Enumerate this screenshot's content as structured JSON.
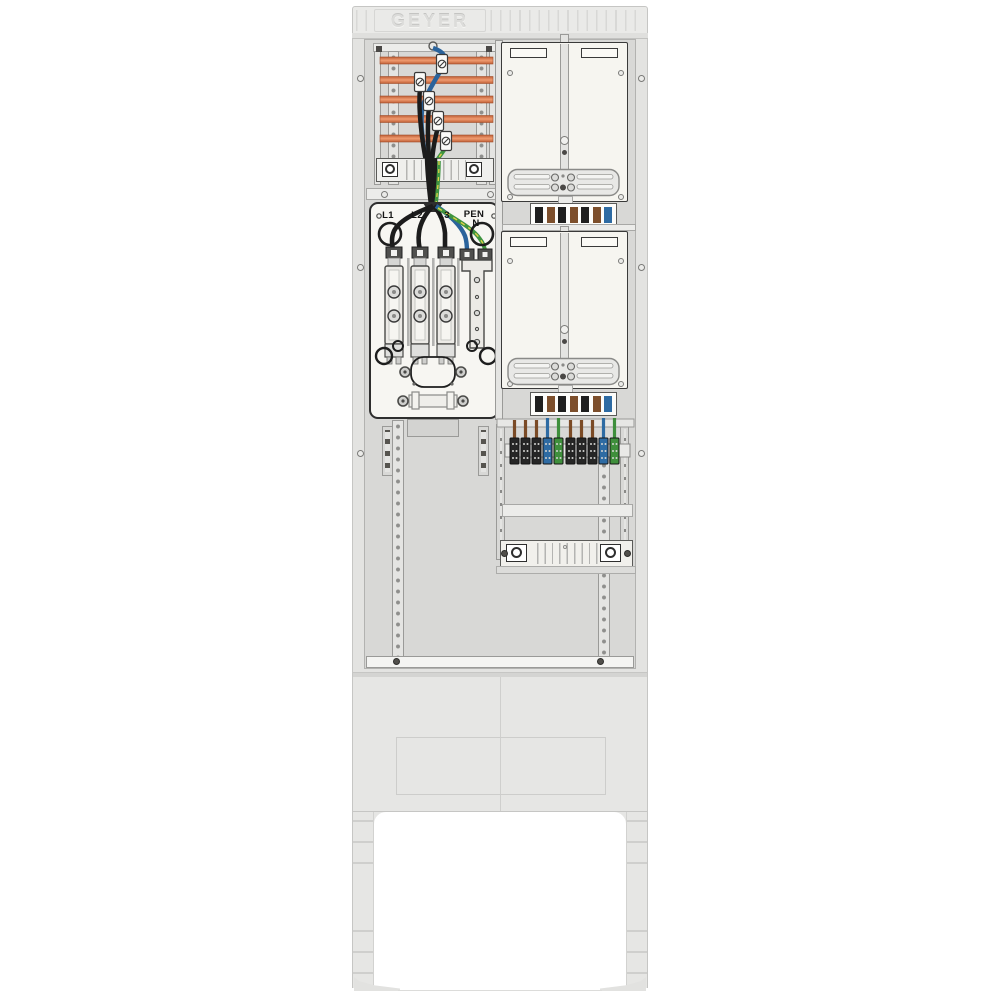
{
  "image": {
    "kind": "technical product illustration",
    "subject": "GEYER outdoor meter connection pillar (Zaehleranschlusssaeule) with open front showing busbars, fuse connection unit, two meter boards and distribution terminals"
  },
  "brand": {
    "logo": "GEYER"
  },
  "connection_box": {
    "phase_labels": [
      "L1",
      "L2",
      "L3",
      "PEN"
    ],
    "neutral_label": "N",
    "fuse_holder_count": 3,
    "incoming_wire_colors": [
      "black",
      "black",
      "black",
      "blue",
      "green-yellow"
    ]
  },
  "busbar_compartment": {
    "busbar_count": 5,
    "busbar_color": "#d4693c",
    "tap_clamp_count": 5,
    "wire_colors": {
      "phase": "#1c1c1c",
      "neutral": "#2a639c",
      "earth": "#3f9440"
    }
  },
  "meter_section": {
    "panel_count": 2,
    "terminal_strip_sequence": [
      "black",
      "brown",
      "black",
      "brown",
      "black",
      "brown",
      "blue"
    ]
  },
  "distribution_terminals": {
    "group_count": 2,
    "block_colors_per_group": [
      "black",
      "black",
      "black",
      "blue",
      "green"
    ],
    "wire_colors_per_group": [
      "brown",
      "brown",
      "brown",
      "blue",
      "green"
    ]
  },
  "palette": {
    "cabinet_body": "#e3e3e1",
    "interior": "#d8d8d6",
    "panel_cream": "#f6f5f0",
    "busbar_orange": "#d4693c",
    "wire_black": "#1c1c1c",
    "wire_blue": "#2a639c",
    "wire_green": "#3f9440",
    "wire_brown": "#7b4b26",
    "terminal_black": "#1f1f1f",
    "terminal_brown": "#7d4f2c",
    "terminal_blue": "#2e6ba3",
    "terminal_green": "#3f8f3c"
  }
}
